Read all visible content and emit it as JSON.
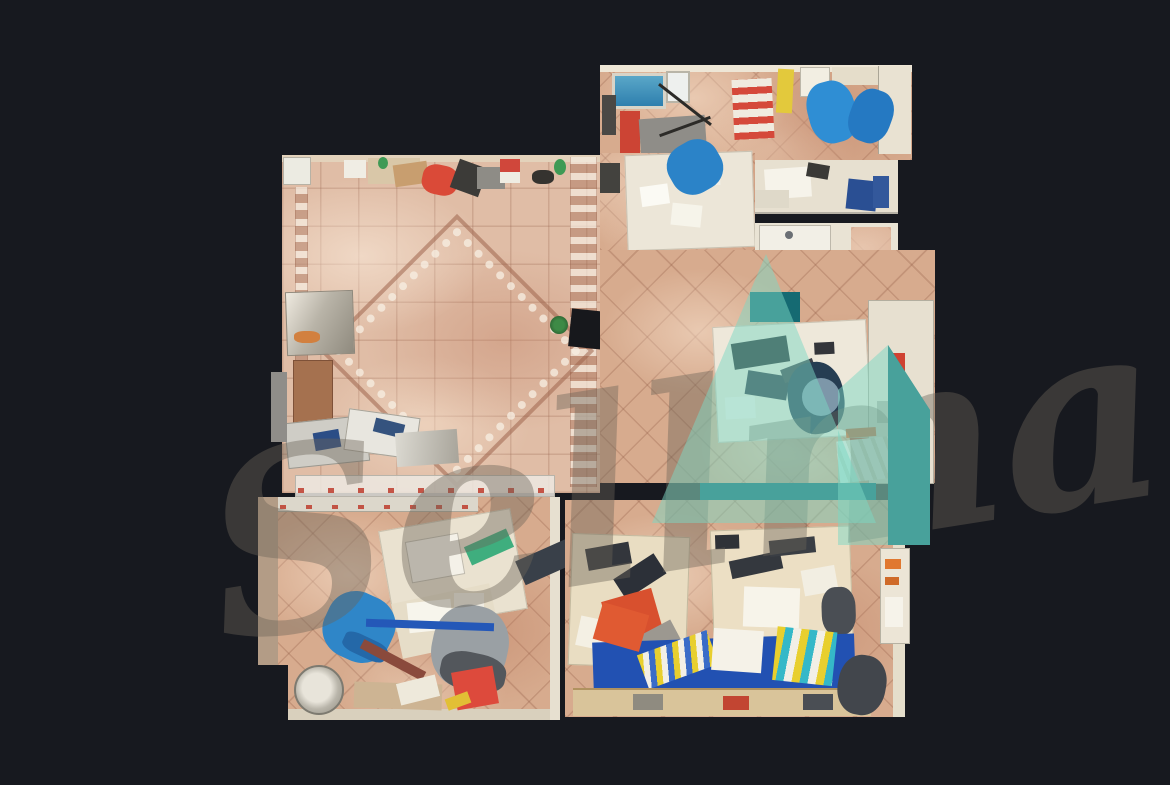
{
  "scene": {
    "description": "Top-down dollhouse 3D scan of a tiled office floor plan shown on a dark backdrop",
    "background_color": "#17191f"
  },
  "watermark": {
    "script_text": "Sellma",
    "script_color": "#6b6458",
    "logo_light_teal": "#7cd7c4",
    "logo_dark_teal": "#156a72"
  },
  "palette": {
    "floor_tile": "#d7ab8e",
    "hall_tile": "#e0bda6",
    "grout": "#945e48",
    "wall": "#e7dfcd",
    "desk_white": "#ece6d8",
    "desk_cream": "#e9ddc2",
    "chair_blue": "#2f86c8",
    "chair_navy": "#263d52",
    "chair_gray": "#9aa0a4",
    "files_blue": "#2251b2",
    "folder_yellow": "#e8cf2e",
    "folder_red": "#d8502e",
    "accent_red": "#da4a38",
    "accent_green": "#3fae7e",
    "metal": "#cfcdc6"
  }
}
